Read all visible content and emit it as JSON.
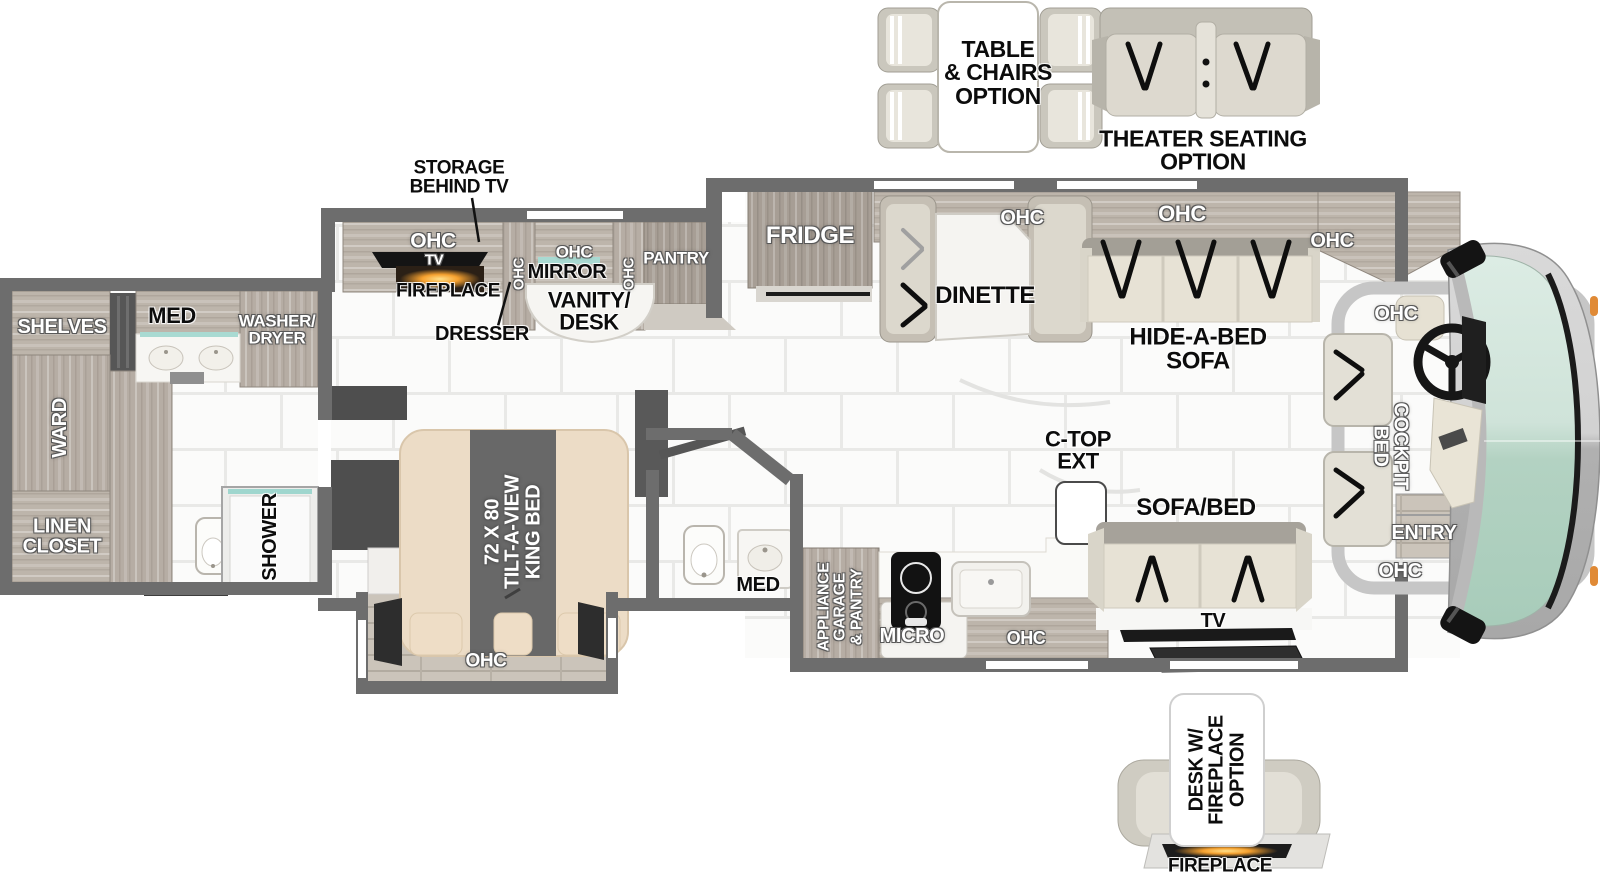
{
  "title": "Motorhome Floorplan Diagram",
  "colors": {
    "wall": "#6d6d6d",
    "wood": "#b6ada4",
    "wood_dark": "#a79e95",
    "tile": "#fbfbfa",
    "grout": "#e8e8e6",
    "mattress": "#ecdcc6",
    "sofa_cream": "#e7e2d5",
    "windshield_teal": "#cfe3d9",
    "fireplace_glow": "#f6a12f",
    "accent_teal": "#a9dad2"
  },
  "options": {
    "table_chairs": {
      "lines": [
        "TABLE",
        "& CHAIRS",
        "OPTION"
      ]
    },
    "theater_seating": {
      "lines": [
        "THEATER SEATING",
        "OPTION"
      ]
    },
    "desk_fireplace": {
      "lines": [
        "DESK W/",
        "FIREPLACE",
        "OPTION"
      ],
      "fireplace_label": "FIREPLACE"
    }
  },
  "rear_bath": {
    "shelves": "SHELVES",
    "med": "MED",
    "washer_dryer": [
      "WASHER/",
      "DRYER"
    ],
    "ward": "WARD",
    "linen_closet": [
      "LINEN",
      "CLOSET"
    ],
    "shower": "SHOWER"
  },
  "bedroom": {
    "storage_behind_tv": [
      "STORAGE",
      "BEHIND TV"
    ],
    "ohc": "OHC",
    "tv": "TV",
    "fireplace": "FIREPLACE",
    "mirror": "MIRROR",
    "vanity_desk": [
      "VANITY/",
      "DESK"
    ],
    "dresser": "DRESSER",
    "pantry": "PANTRY",
    "king_bed": [
      "72 X 80",
      "TILT-A-VIEW",
      "KING BED"
    ]
  },
  "mid_bath": {
    "med": "MED"
  },
  "kitchen": {
    "appliance_garage": [
      "APPLIANCE",
      "GARAGE",
      "& PANTRY"
    ],
    "micro": "MICRO",
    "ohc": "OHC",
    "ctop_ext": [
      "C-TOP",
      "EXT"
    ]
  },
  "living": {
    "fridge": "FRIDGE",
    "dinette": "DINETTE",
    "ohc": "OHC",
    "hide_a_bed": [
      "HIDE-A-BED",
      "SOFA"
    ],
    "sofa_bed": "SOFA/BED",
    "tv": "TV"
  },
  "cockpit": {
    "ohc": "OHC",
    "cockpit_bed": [
      "COCKPIT",
      "BED"
    ],
    "entry": "ENTRY"
  }
}
